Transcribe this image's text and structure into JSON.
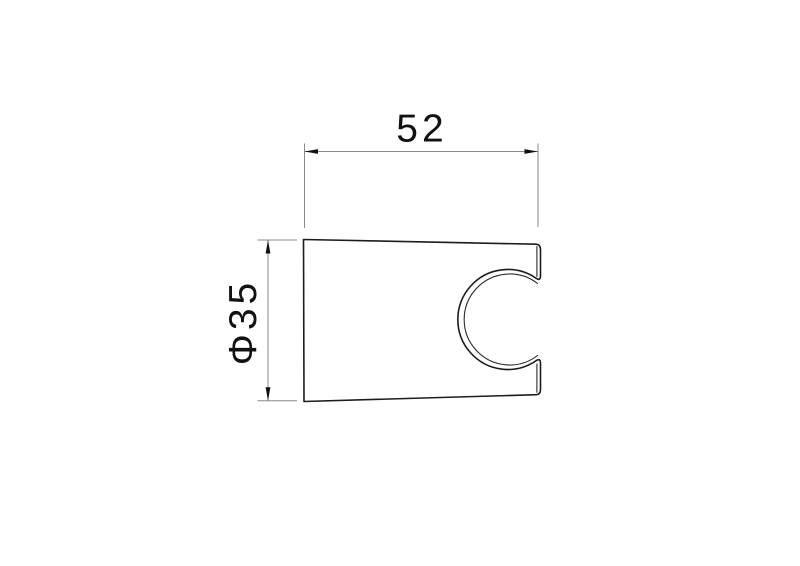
{
  "page": {
    "background_color": "#ffffff"
  },
  "drawing": {
    "type": "technical-dimension-drawing",
    "view": "shower-holder-bracket-profile-with-c-shaped-clamp-cutout",
    "outline_color": "#1c1c1c",
    "dim_line_color": "#8a8a8a",
    "text_color": "#111111",
    "width_dimension": {
      "label": "52",
      "orientation": "horizontal"
    },
    "diameter_dimension": {
      "label": "Φ35",
      "orientation": "vertical-rotated"
    }
  }
}
